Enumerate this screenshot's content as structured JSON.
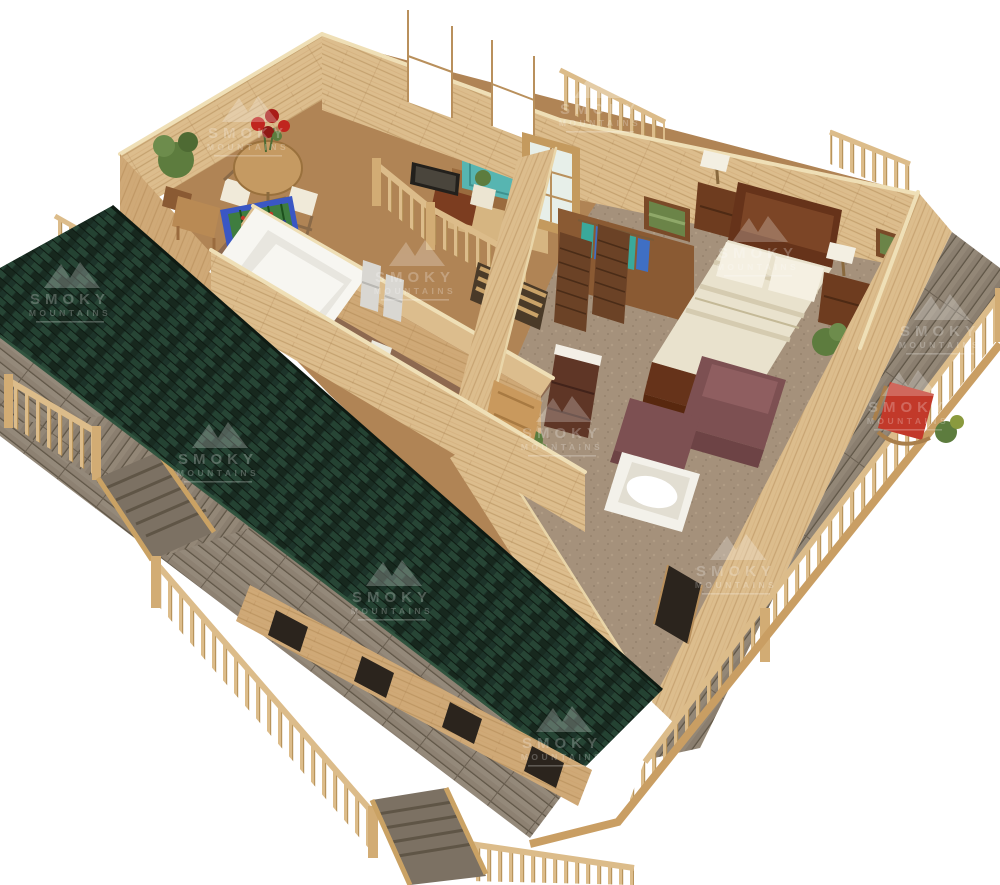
{
  "page": {
    "background": "#ffffff"
  },
  "watermark": {
    "line1": "SMOKY",
    "line2": "MOUNTAINS",
    "color": "#ffffff",
    "opacity": 0.24
  },
  "colors": {
    "roof_base": "#1d342a",
    "wall_wood": "#dcbd8d",
    "wall_wood_shade": "#cfa977",
    "wall_top": "#efdfb6",
    "floor_loft": "#b08455",
    "floor_bath": "#8d6950",
    "carpet": "#a5917b",
    "deck_board": "#8d8172",
    "deck_fascia": "#c99e63",
    "railing_wood": "#dcbc8a",
    "bed_wood": "#66331a",
    "bedding": "#e9e2cd",
    "pillow": "#f5f0e2",
    "nightstand": "#6e3c1f",
    "dresser": "#5f3626",
    "armchair": "#7d5052",
    "chair_red": "#c2392a",
    "hot_tub_water": "#57b5b1",
    "hot_tub_wood": "#9a6b3e",
    "foosball_field": "#3f7d3f",
    "foosball_rim": "#3a57c4",
    "shower_white": "#f7f6f1",
    "fixture_white": "#f3f1ea",
    "plant_green": "#5d7c3e",
    "flower_red": "#c0251f",
    "picture_art": "#6b8448",
    "window_dark": "#2b241d",
    "glass": "#e7efe9",
    "clothes_teal": "#3aa99b",
    "clothes_blue": "#3f6fc4",
    "clothes_green": "#49a050",
    "closet_door": "#6b4226",
    "tv_dark": "#23201c",
    "desk_wood": "#7c3d20",
    "table_wood": "#c59a62"
  },
  "scene": {
    "label": "3D cutaway rendering of log cabin upper floor",
    "elements": [
      "porch-roof",
      "wraparound-deck",
      "loft-game-area",
      "dining-table",
      "foosball-table",
      "bathroom",
      "shower",
      "double-vanity",
      "toilet",
      "hot-tub",
      "french-door",
      "staircase",
      "closet",
      "bedroom",
      "bed",
      "nightstand",
      "table-lamp",
      "armchair",
      "ottoman",
      "jetted-tub",
      "tv",
      "deck-rocking-chair"
    ]
  }
}
